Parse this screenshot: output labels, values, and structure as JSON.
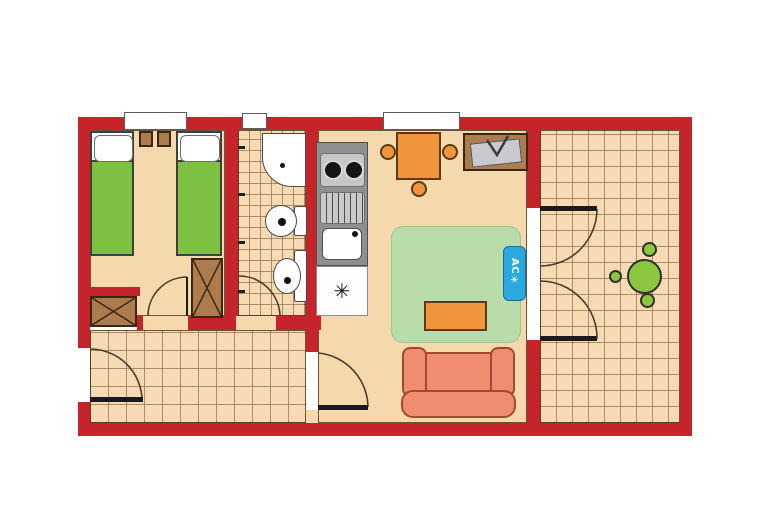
{
  "diagram": {
    "type": "floor-plan",
    "description": "Apartment floor plan with bedroom, bathroom, hallway, living room with kitchenette, and tiled terrace"
  },
  "labels": {
    "ac_unit": "AC",
    "ac_snowflake": "✳",
    "fridge_symbol": "✳"
  },
  "colors": {
    "wall_red": "#c5242b",
    "floor_beige": "#f6d8ad",
    "tile_beige": "#f6dab4",
    "bed_green": "#7cc142",
    "rug_green": "#b9dcab",
    "terrace_table_green": "#8dc63f",
    "furniture_orange": "#f0953c",
    "wood_brown": "#ac7c4e",
    "sofa_coral": "#ef8d73",
    "ac_blue": "#2aa9e0",
    "counter_gray": "#8f8f8f"
  },
  "rooms": [
    {
      "name": "bedroom",
      "floor": "plain",
      "furniture": [
        "twin-bed",
        "twin-bed",
        "nightstand",
        "nightstand",
        "wardrobe",
        "closet"
      ]
    },
    {
      "name": "bathroom",
      "floor": "small-tiles",
      "furniture": [
        "shower",
        "toilet",
        "bidet"
      ]
    },
    {
      "name": "hallway",
      "floor": "medium-tiles",
      "furniture": []
    },
    {
      "name": "living-kitchen",
      "floor": "plain",
      "furniture": [
        "kitchen-counter",
        "stove",
        "sink",
        "fridge",
        "dining-table",
        "chair",
        "chair",
        "chair",
        "tv-stand",
        "rug",
        "coffee-table",
        "sofa",
        "ac-unit"
      ]
    },
    {
      "name": "terrace",
      "floor": "large-tiles",
      "furniture": [
        "round-table",
        "chair",
        "chair",
        "chair"
      ]
    }
  ],
  "openings": {
    "windows": 3,
    "doors": [
      "entrance",
      "bedroom",
      "bathroom",
      "living-room",
      "french-double-door-to-terrace"
    ]
  }
}
